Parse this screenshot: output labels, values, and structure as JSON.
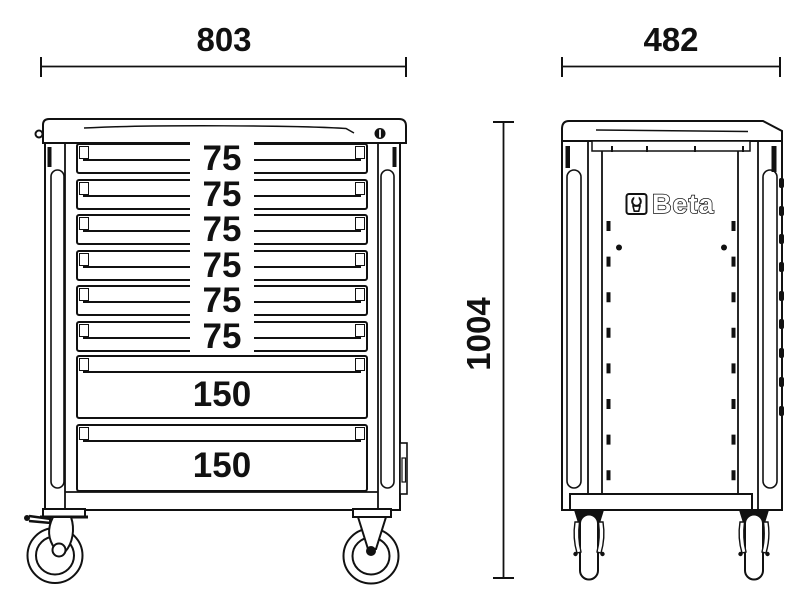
{
  "drawing": {
    "background": "#ffffff",
    "ink": "#111111"
  },
  "front_view": {
    "width_dimension": "803",
    "drawers": [
      {
        "label": "75"
      },
      {
        "label": "75"
      },
      {
        "label": "75"
      },
      {
        "label": "75"
      },
      {
        "label": "75"
      },
      {
        "label": "75"
      },
      {
        "label": "150"
      },
      {
        "label": "150"
      }
    ]
  },
  "side_view": {
    "depth_dimension": "482",
    "height_dimension": "1004",
    "logo_text": "Beta",
    "logo_icon": "beta-brand-icon"
  }
}
